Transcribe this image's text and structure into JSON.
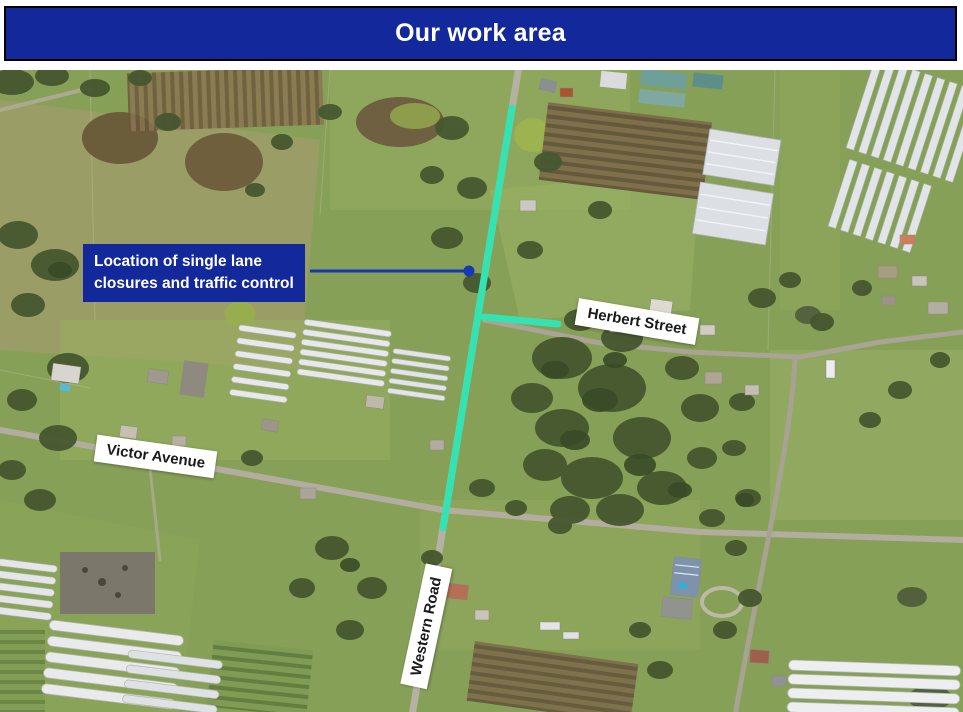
{
  "header": {
    "title": "Our work area"
  },
  "colors": {
    "banner_bg": "#12289b",
    "banner_text": "#ffffff",
    "work_area_highlight": "#35e3b2",
    "callout_connector": "#1737b4",
    "street_label_bg": "#ffffff",
    "street_label_text": "#1a1a1a"
  },
  "map": {
    "callout": {
      "line1": "Location of single lane",
      "line2": "closures and traffic control"
    },
    "street_labels": [
      {
        "id": "herbert-street",
        "text": "Herbert Street"
      },
      {
        "id": "victor-avenue",
        "text": "Victor Avenue"
      },
      {
        "id": "western-road",
        "text": "Western Road"
      }
    ]
  }
}
